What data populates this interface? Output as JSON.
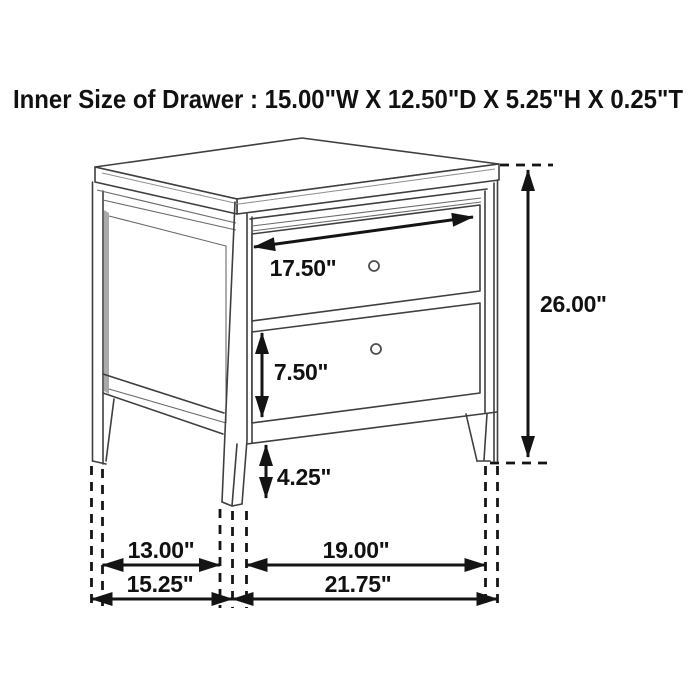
{
  "title": {
    "text": "Inner Size of Drawer : 15.00\"W X 12.50\"D X 5.25\"H X 0.25\"T"
  },
  "diagram": {
    "type": "furniture-dimension-diagram",
    "subject": "two-drawer nightstand line drawing with dimension arrows",
    "inner_drawer_size": {
      "width": "15.00\"",
      "depth": "12.50\"",
      "height": "5.25\"",
      "thickness": "0.25\""
    },
    "labels": {
      "drawer_width": "17.50\"",
      "bottom_drawer_height": "7.50\"",
      "base_clearance": "4.25\"",
      "overall_height": "26.00\"",
      "side_leg_spacing": "13.00\"",
      "overall_depth": "15.25\"",
      "front_leg_spacing": "19.00\"",
      "overall_width": "21.75\""
    },
    "colors": {
      "line": "#3f3f3f",
      "dimension": "#141414",
      "panel_shadow": "#a9a9a9",
      "background": "#ffffff"
    }
  }
}
